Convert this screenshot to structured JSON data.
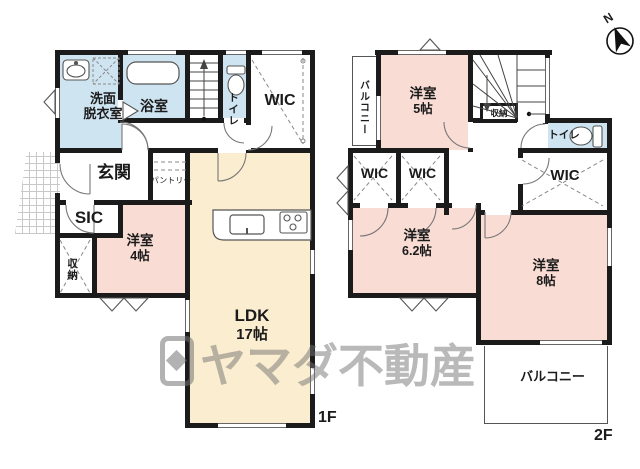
{
  "watermark": {
    "text": "ヤマダ不動産"
  },
  "compass": {
    "label": "N"
  },
  "floor1": {
    "label": "1F",
    "rooms": {
      "washroom": {
        "line1": "洗面",
        "line2": "脱衣室"
      },
      "bath": {
        "label": "浴室"
      },
      "toilet": {
        "label": "トイレ"
      },
      "wic": {
        "label": "WIC"
      },
      "entrance": {
        "label": "玄関"
      },
      "pantry": {
        "label": "パントリー"
      },
      "sic": {
        "label": "SIC"
      },
      "storage": {
        "label": "収納"
      },
      "bedroom4": {
        "name": "洋室",
        "size": "4帖"
      },
      "ldk": {
        "name": "LDK",
        "size": "17帖"
      }
    }
  },
  "floor2": {
    "label": "2F",
    "rooms": {
      "balcony_west": {
        "label": "バルコニー"
      },
      "bedroom5": {
        "name": "洋室",
        "size": "5帖"
      },
      "storage": {
        "label": "収納"
      },
      "toilet": {
        "label": "トイレ"
      },
      "wic_a": {
        "label": "WIC"
      },
      "wic_b": {
        "label": "WIC"
      },
      "wic_c": {
        "label": "WIC"
      },
      "bedroom6": {
        "name": "洋室",
        "size": "6.2帖"
      },
      "bedroom8": {
        "name": "洋室",
        "size": "8帖"
      },
      "balcony_south": {
        "label": "バルコニー"
      }
    }
  },
  "colors": {
    "wall": "#1b1b1b",
    "room_blue": "#cfe4f1",
    "room_pink": "#f9dcd4",
    "room_cream": "#fbedcf",
    "watermark_gray": "#737373"
  }
}
